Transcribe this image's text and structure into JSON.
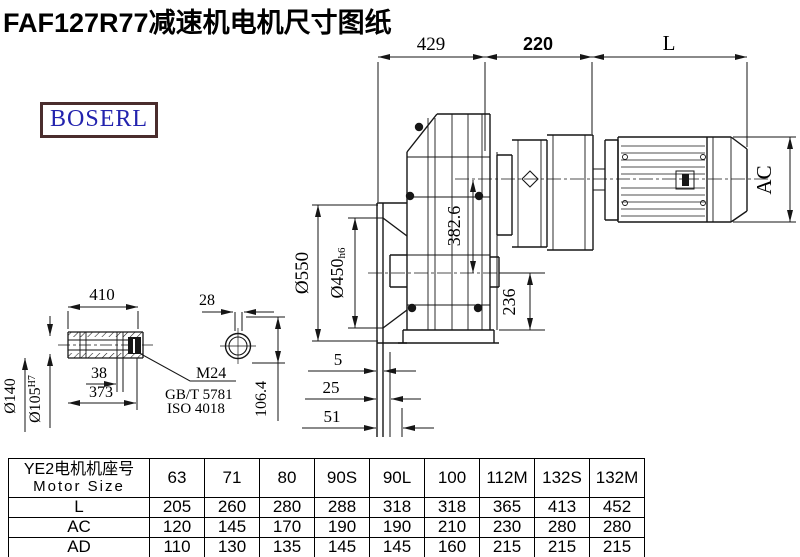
{
  "title": "FAF127R77减速机电机尺寸图纸",
  "logo": {
    "text": "BOSERL"
  },
  "colors": {
    "line": "#161616",
    "logo_border": "#4a2d2d",
    "logo_text": "#2323ae"
  },
  "drawing": {
    "dims": {
      "width_429": "429",
      "width_220": "220",
      "length_L": "L",
      "motor_ac": "AC",
      "flange_dia": "Ø550",
      "spigot_dia": "Ø450",
      "spigot_tol": "h6",
      "center_dist": "382.6",
      "base_height": "236",
      "shaft_len": "410",
      "shaft_od": "Ø140",
      "bore_dia": "Ø105",
      "bore_tol": "H7",
      "key_38": "38",
      "key_373": "373",
      "thread": "M24",
      "std1": "GB/T 5781",
      "std2": "ISO 4018",
      "slot_28": "28",
      "height_1064": "106.4",
      "off_5": "5",
      "off_25": "25",
      "off_51": "51"
    }
  },
  "table": {
    "header_cn": "YE2电机机座号",
    "header_en": "Motor Size",
    "columns": [
      "63",
      "71",
      "80",
      "90S",
      "90L",
      "100",
      "112M",
      "132S",
      "132M"
    ],
    "rows": [
      {
        "label": "L",
        "values": [
          "205",
          "260",
          "280",
          "288",
          "318",
          "318",
          "365",
          "413",
          "452"
        ]
      },
      {
        "label": "AC",
        "values": [
          "120",
          "145",
          "170",
          "190",
          "190",
          "210",
          "230",
          "280",
          "280"
        ]
      },
      {
        "label": "AD",
        "values": [
          "110",
          "130",
          "135",
          "145",
          "145",
          "160",
          "215",
          "215",
          "215"
        ]
      }
    ]
  }
}
